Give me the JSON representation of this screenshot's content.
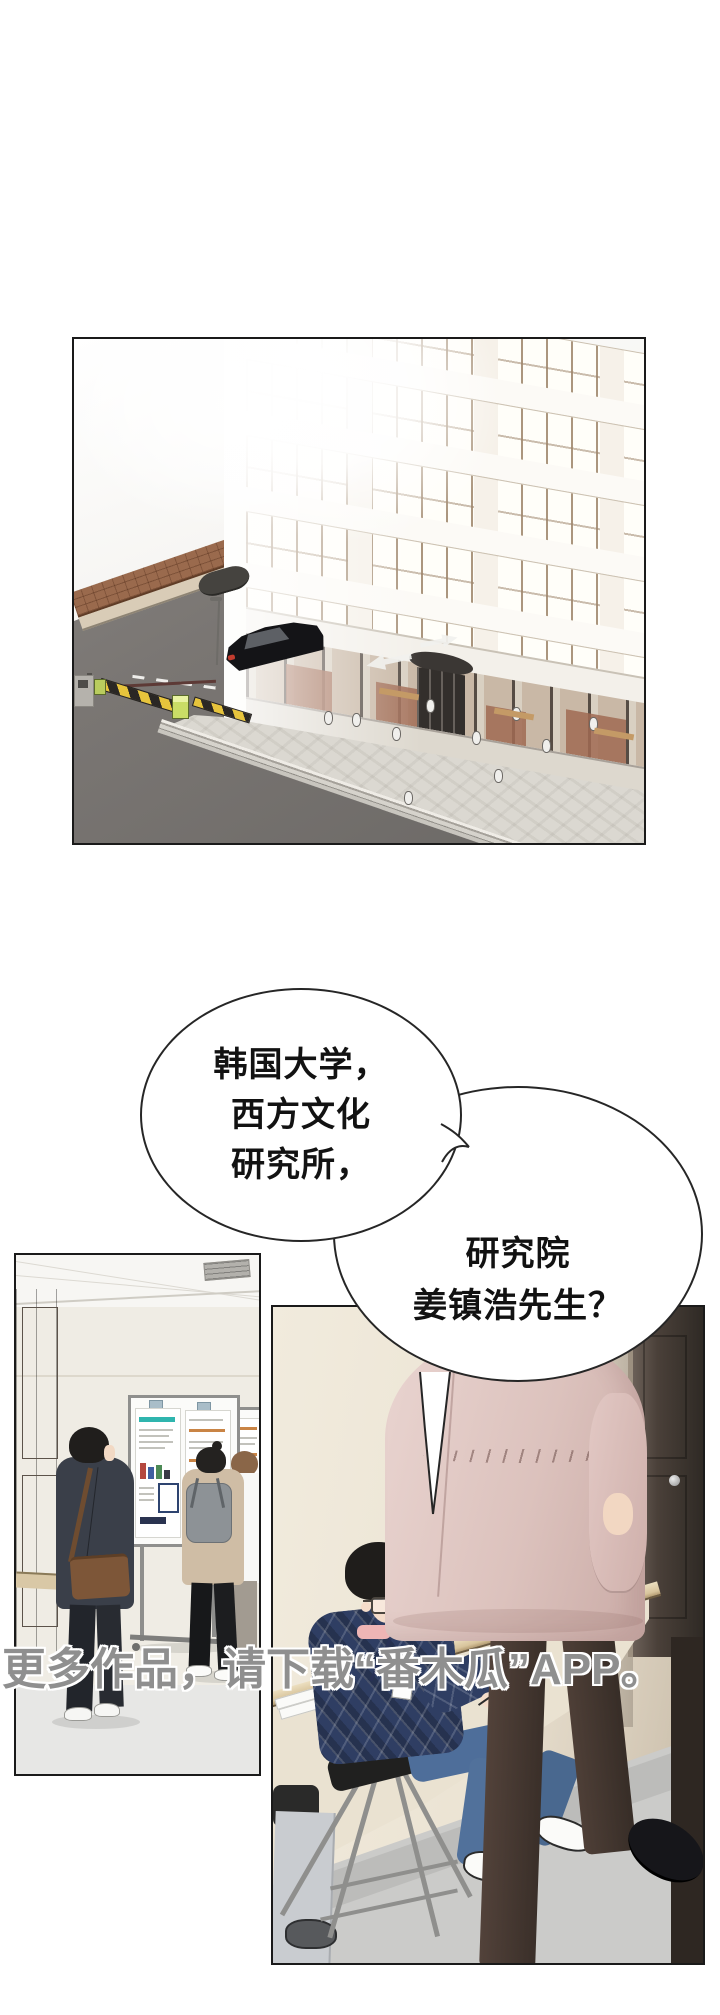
{
  "comic": {
    "bubble_left": {
      "lines": [
        "韩国大学，",
        "西方文化",
        "研究所，"
      ]
    },
    "bubble_right": {
      "lines": [
        "研究院",
        "姜镇浩先生？"
      ]
    },
    "watermark": "更多作品，请下载“番木瓜”APP。",
    "palette": {
      "watermark_gray": "#8f8f8f",
      "coat_pink": "#dcc2bd",
      "sweater_navy": "#2f3e63",
      "street_gray": "#7a7673",
      "brick_brown": "#9a6a4d",
      "poster_teal": "#2fb5ae",
      "poster_orange": "#c98445",
      "counter_wood": "#d8c49c"
    }
  }
}
